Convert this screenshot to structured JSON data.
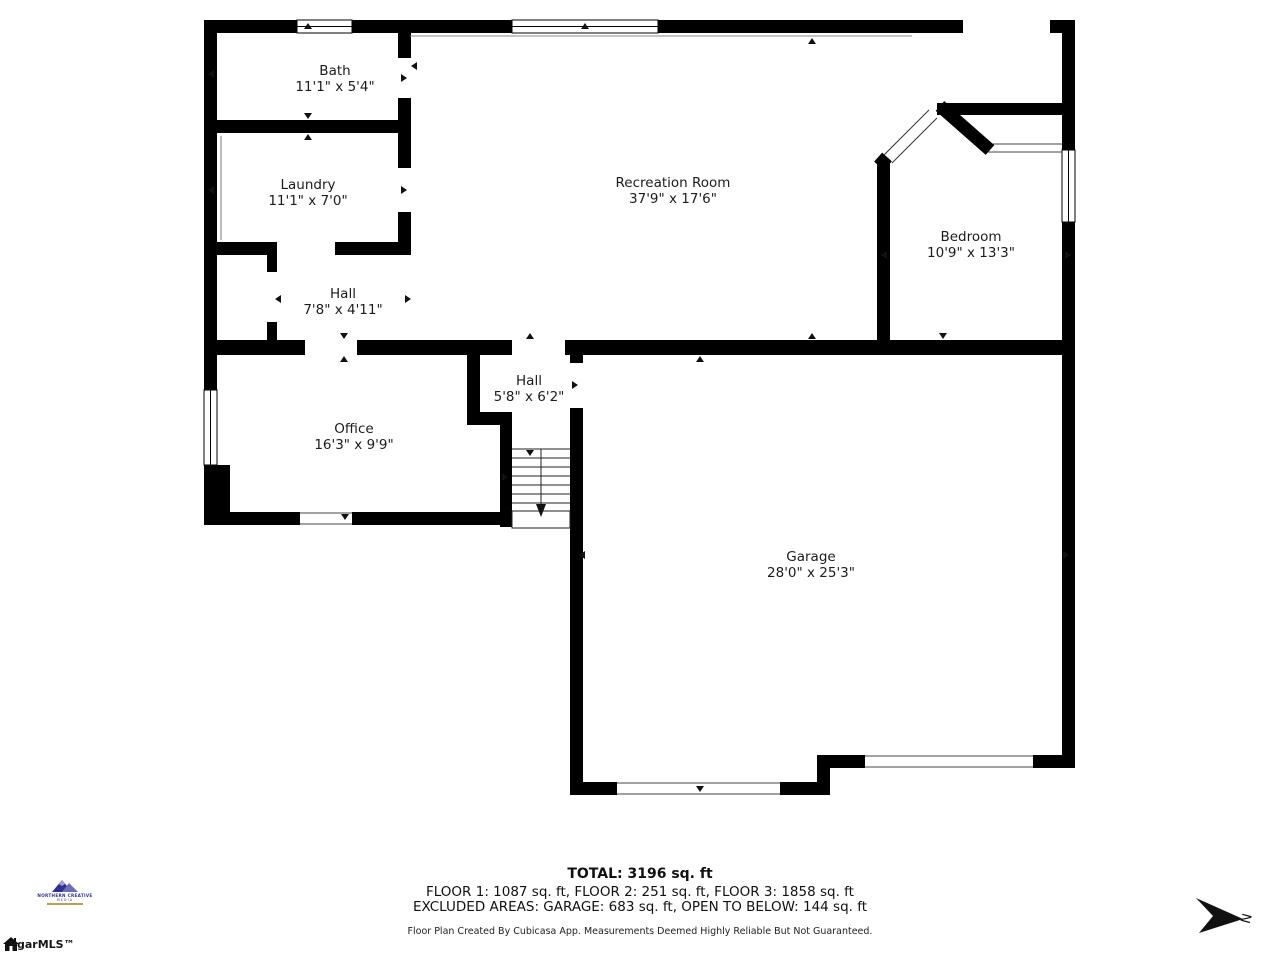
{
  "rooms": [
    {
      "name": "Bath",
      "dims": "11'1\" x 5'4\""
    },
    {
      "name": "Laundry",
      "dims": "11'1\" x 7'0\""
    },
    {
      "name": "Recreation Room",
      "dims": "37'9\" x 17'6\""
    },
    {
      "name": "Bedroom",
      "dims": "10'9\" x 13'3\""
    },
    {
      "name": "Hall",
      "dims": "7'8\" x 4'11\""
    },
    {
      "name": "Hall",
      "dims": "5'8\" x 6'2\""
    },
    {
      "name": "Office",
      "dims": "16'3\" x 9'9\""
    },
    {
      "name": "Garage",
      "dims": "28'0\" x 25'3\""
    }
  ],
  "footer": {
    "total": "TOTAL: 3196 sq. ft",
    "floors": "FLOOR 1: 1087 sq. ft, FLOOR 2: 251 sq. ft, FLOOR 3: 1858 sq. ft",
    "excluded": "EXCLUDED AREAS: GARAGE: 683 sq. ft, OPEN TO BELOW: 144 sq. ft",
    "disclaimer": "Floor Plan Created By Cubicasa App. Measurements Deemed Highly Reliable But Not Guaranteed."
  },
  "branding": {
    "logo_line1": "NORTHERN CREATIVE",
    "logo_line2": "MEDIA",
    "mls_label": "garMLS™"
  },
  "compass": {
    "north_label": "N"
  },
  "colors": {
    "wall": "#000000",
    "background": "#ffffff",
    "text": "#1a1a1a",
    "logo_navy": "#2e3191",
    "logo_gold": "#b08d3f"
  }
}
